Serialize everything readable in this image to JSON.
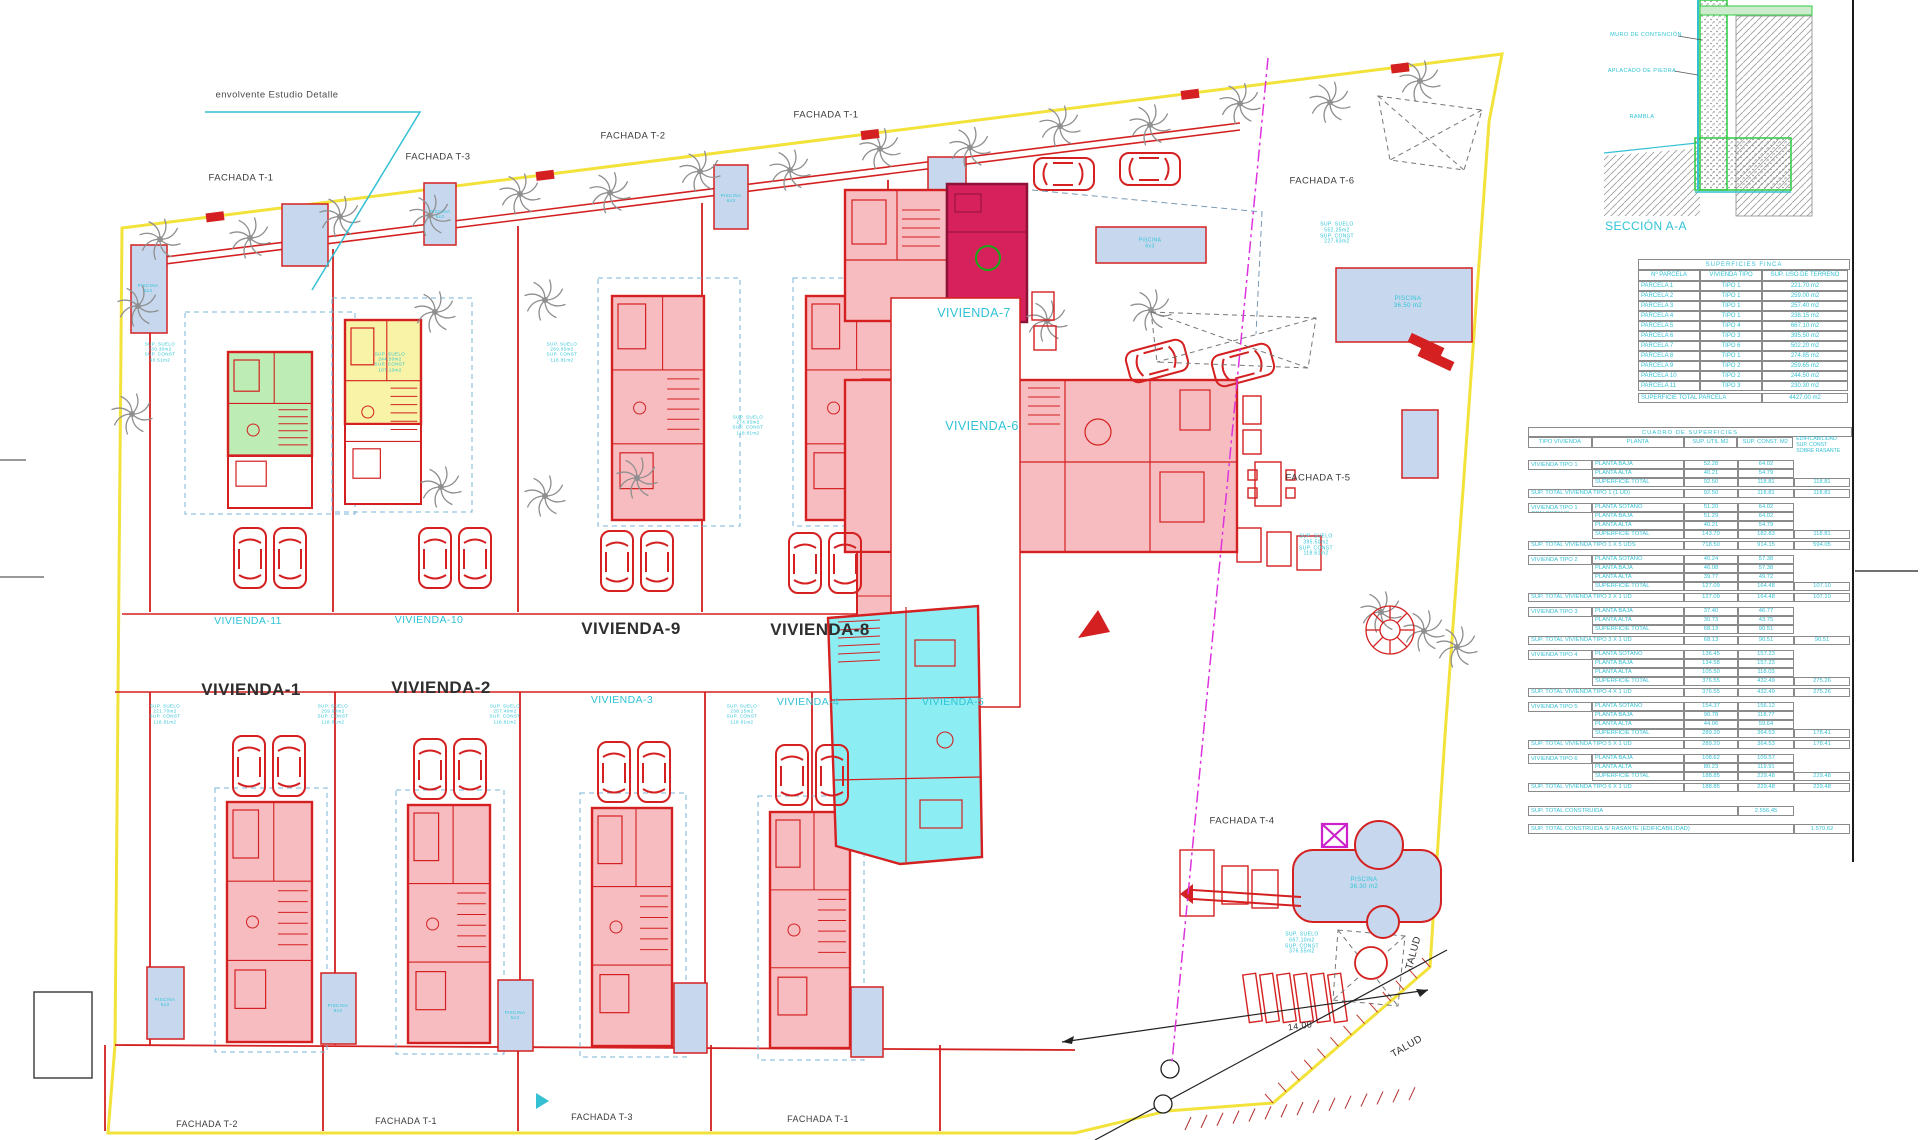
{
  "drawing_title": "Plano de emplazamiento viviendas",
  "colors": {
    "boundary_yellow": "#f2e23a",
    "wall_red": "#d42020",
    "plan_pink": "#f7bcc0",
    "plan_green": "#bdecb4",
    "plan_yellow": "#f8f3a6",
    "plan_crimson": "#d6215d",
    "plan_cyan": "#8ceef2",
    "pool_blue": "#c7d8ee",
    "annotation_cyan": "#2fc3d6",
    "magenta_line": "#dd33dd",
    "tree_gray": "#8f8f8f"
  },
  "plan_labels": [
    {
      "name": "label-envolvente-estudio-detalle",
      "text": "envolvente Estudio Detalle",
      "x": 277,
      "y": 96,
      "size": 9.5,
      "color": "#4a4a4a"
    },
    {
      "name": "label-fachada-t1-top-left",
      "text": "FACHADA T-1",
      "x": 241,
      "y": 179,
      "size": 9.5,
      "color": "#3c3c3c"
    },
    {
      "name": "label-fachada-t3-top",
      "text": "FACHADA T-3",
      "x": 438,
      "y": 158,
      "size": 9.5,
      "color": "#3c3c3c"
    },
    {
      "name": "label-fachada-t2-top",
      "text": "FACHADA T-2",
      "x": 633,
      "y": 137,
      "size": 9.5,
      "color": "#3c3c3c"
    },
    {
      "name": "label-fachada-t1-top",
      "text": "FACHADA T-1",
      "x": 826,
      "y": 116,
      "size": 9.5,
      "color": "#3c3c3c"
    },
    {
      "name": "label-fachada-t6",
      "text": "FACHADA T-6",
      "x": 1322,
      "y": 182,
      "size": 9.5,
      "color": "#3c3c3c"
    },
    {
      "name": "label-fachada-t5",
      "text": "FACHADA T-5",
      "x": 1318,
      "y": 479,
      "size": 9.5,
      "color": "#3c3c3c"
    },
    {
      "name": "label-fachada-t4",
      "text": "FACHADA T-4",
      "x": 1242,
      "y": 822,
      "size": 9.5,
      "color": "#3c3c3c"
    },
    {
      "name": "label-fachada-t2-bottom",
      "text": "FACHADA T-2",
      "x": 207,
      "y": 1124,
      "size": 9,
      "color": "#3c3c3c"
    },
    {
      "name": "label-fachada-t1-bottom-a",
      "text": "FACHADA T-1",
      "x": 406,
      "y": 1121,
      "size": 9,
      "color": "#3c3c3c"
    },
    {
      "name": "label-fachada-t3-bottom",
      "text": "FACHADA T-3",
      "x": 602,
      "y": 1117,
      "size": 9,
      "color": "#3c3c3c"
    },
    {
      "name": "label-fachada-t1-bottom-b",
      "text": "FACHADA T-1",
      "x": 818,
      "y": 1119,
      "size": 9,
      "color": "#3c3c3c"
    },
    {
      "name": "label-vivienda-11",
      "text": "VIVIENDA-11",
      "x": 248,
      "y": 621,
      "size": 10.5,
      "color": "#2fc3d6"
    },
    {
      "name": "label-vivienda-10",
      "text": "VIVIENDA-10",
      "x": 429,
      "y": 620,
      "size": 10.5,
      "color": "#2fc3d6"
    },
    {
      "name": "label-vivienda-9",
      "text": "VIVIENDA-9",
      "x": 631,
      "y": 629,
      "size": 17,
      "color": "#2e2e2e",
      "bold": true
    },
    {
      "name": "label-vivienda-8",
      "text": "VIVIENDA-8",
      "x": 820,
      "y": 630,
      "size": 17,
      "color": "#2e2e2e",
      "bold": true
    },
    {
      "name": "label-vivienda-1",
      "text": "VIVIENDA-1",
      "x": 251,
      "y": 690,
      "size": 17,
      "color": "#2e2e2e",
      "bold": true
    },
    {
      "name": "label-vivienda-2",
      "text": "VIVIENDA-2",
      "x": 441,
      "y": 688,
      "size": 17,
      "color": "#2e2e2e",
      "bold": true
    },
    {
      "name": "label-vivienda-3",
      "text": "VIVIENDA-3",
      "x": 622,
      "y": 700,
      "size": 10.5,
      "color": "#2fc3d6"
    },
    {
      "name": "label-vivienda-4",
      "text": "VIVIENDA-4",
      "x": 808,
      "y": 702,
      "size": 10.5,
      "color": "#2fc3d6"
    },
    {
      "name": "label-vivienda-5",
      "text": "VIVIENDA-5",
      "x": 953,
      "y": 702,
      "size": 10.5,
      "color": "#2fc3d6"
    },
    {
      "name": "label-vivienda-7",
      "text": "VIVIENDA-7",
      "x": 974,
      "y": 313,
      "size": 12.5,
      "color": "#2fc3d6"
    },
    {
      "name": "label-vivienda-6",
      "text": "VIVIENDA-6",
      "x": 982,
      "y": 426,
      "size": 12.5,
      "color": "#2fc3d6"
    },
    {
      "name": "label-talud-east",
      "text": "TALUD",
      "x": 1414,
      "y": 953,
      "size": 10,
      "color": "#2e2e2e",
      "rot": -75
    },
    {
      "name": "label-talud-south",
      "text": "TALUD",
      "x": 1407,
      "y": 1047,
      "size": 10,
      "color": "#2e2e2e",
      "rot": -30
    },
    {
      "name": "label-dimension-14",
      "text": "14.00",
      "x": 1300,
      "y": 1026,
      "size": 9,
      "color": "#2e2e2e",
      "rot": -8
    },
    {
      "name": "label-seccion-aa",
      "text": "SECCIÓN A-A",
      "x": 1646,
      "y": 227,
      "size": 12,
      "color": "#2fc3d6"
    },
    {
      "name": "label-muro-contencion",
      "text": "MURO DE CONTENCIÓN",
      "x": 1646,
      "y": 35,
      "size": 5.5,
      "color": "#2fc3d6"
    },
    {
      "name": "label-aplacado-piedra",
      "text": "APLACADO DE PIEDRA",
      "x": 1642,
      "y": 71,
      "size": 5.5,
      "color": "#2fc3d6"
    },
    {
      "name": "label-rambla",
      "text": "RAMBLA",
      "x": 1642,
      "y": 117,
      "size": 5.5,
      "color": "#2fc3d6"
    },
    {
      "name": "label-sup-parcela-7",
      "text": "SUP. SUELO\n552.25m2\nSUP. CONST\n227.63m2",
      "x": 1337,
      "y": 234,
      "size": 5,
      "color": "#2fc3d6"
    },
    {
      "name": "label-sup-parcela-6",
      "text": "SUP. SUELO\n395.50m2\nSUP. CONST\n118.61m2",
      "x": 1316,
      "y": 546,
      "size": 5,
      "color": "#2fc3d6"
    },
    {
      "name": "label-sup-parcela-5",
      "text": "SUP. SUELO\n667.10m2\nSUP. CONST\n376.55m2",
      "x": 1302,
      "y": 944,
      "size": 5,
      "color": "#2fc3d6"
    },
    {
      "name": "label-piscina-northeast",
      "text": "PISCINA\n36.50 m2",
      "x": 1408,
      "y": 303,
      "size": 6,
      "color": "#2fc3d6"
    },
    {
      "name": "label-piscina-southeast",
      "text": "PISCINA\n36.30 m2",
      "x": 1364,
      "y": 884,
      "size": 6,
      "color": "#2fc3d6"
    },
    {
      "name": "label-piscina-north",
      "text": "PISCINA\n6x3",
      "x": 1150,
      "y": 244,
      "size": 5,
      "color": "#2fc3d6"
    },
    {
      "name": "label-sup-vivienda-11",
      "text": "SUP. SUELO\n230.30m2\nSUP. CONST\n90.51m2",
      "x": 160,
      "y": 352,
      "size": 4.5,
      "color": "#2fc3d6"
    },
    {
      "name": "label-sup-vivienda-10",
      "text": "SUP. SUELO\n244.50m2\nSUP. CONST\n107.10m2",
      "x": 390,
      "y": 362,
      "size": 4.5,
      "color": "#2fc3d6"
    },
    {
      "name": "label-sup-vivienda-9",
      "text": "SUP. SUELO\n259.65m2\nSUP. CONST\n118.81m2",
      "x": 562,
      "y": 352,
      "size": 4.5,
      "color": "#2fc3d6"
    },
    {
      "name": "label-sup-vivienda-8",
      "text": "SUP. SUELO\n274.85m2\nSUP. CONST\n118.81m2",
      "x": 748,
      "y": 425,
      "size": 4.5,
      "color": "#2fc3d6"
    },
    {
      "name": "label-sup-vivienda-1",
      "text": "SUP. SUELO\n221.70m2\nSUP. CONST\n118.81m2",
      "x": 165,
      "y": 714,
      "size": 4.5,
      "color": "#2fc3d6"
    },
    {
      "name": "label-sup-vivienda-2",
      "text": "SUP. SUELO\n259.00m2\nSUP. CONST\n118.81m2",
      "x": 333,
      "y": 714,
      "size": 4.5,
      "color": "#2fc3d6"
    },
    {
      "name": "label-sup-vivienda-3",
      "text": "SUP. SUELO\n257.40m2\nSUP. CONST\n118.81m2",
      "x": 505,
      "y": 714,
      "size": 4.5,
      "color": "#2fc3d6"
    },
    {
      "name": "label-sup-vivienda-4",
      "text": "SUP. SUELO\n238.15m2\nSUP. CONST\n118.81m2",
      "x": 742,
      "y": 714,
      "size": 4.5,
      "color": "#2fc3d6"
    },
    {
      "name": "label-piscina-small-1",
      "text": "PISCINA\n6x3",
      "x": 148,
      "y": 288,
      "size": 4.5,
      "color": "#2fc3d6"
    },
    {
      "name": "label-piscina-small-2",
      "text": "PISCINA\n6x3",
      "x": 440,
      "y": 214,
      "size": 4.5,
      "color": "#2fc3d6"
    },
    {
      "name": "label-piscina-small-3",
      "text": "PISCINA\n6x3",
      "x": 731,
      "y": 198,
      "size": 4.5,
      "color": "#2fc3d6"
    },
    {
      "name": "label-piscina-small-4",
      "text": "PISCINA\n6x3",
      "x": 165,
      "y": 1002,
      "size": 4.5,
      "color": "#2fc3d6"
    },
    {
      "name": "label-piscina-small-5",
      "text": "PISCINA\n6x3",
      "x": 338,
      "y": 1008,
      "size": 4.5,
      "color": "#2fc3d6"
    },
    {
      "name": "label-piscina-small-6",
      "text": "PISCINA\n6x3",
      "x": 515,
      "y": 1015,
      "size": 4.5,
      "color": "#2fc3d6"
    }
  ],
  "finca_table": {
    "title": "SUPERFICIES FINCA",
    "headers": [
      "Nº PARCELA",
      "VIVIENDA TIPO",
      "SUP. USO DE TERRENO"
    ],
    "rows": [
      [
        "PARCELA 1",
        "TIPO 1",
        "221.70 m2"
      ],
      [
        "PARCELA 2",
        "TIPO 1",
        "259.00 m2"
      ],
      [
        "PARCELA 3",
        "TIPO 1",
        "257.40 m2"
      ],
      [
        "PARCELA 4",
        "TIPO 1",
        "238.15 m2"
      ],
      [
        "PARCELA 5",
        "TIPO 4",
        "667.10 m2"
      ],
      [
        "PARCELA 6",
        "TIPO 3",
        "395.50 m2"
      ],
      [
        "PARCELA 7",
        "TIPO 6",
        "502.20 m2"
      ],
      [
        "PARCELA 8",
        "TIPO 1",
        "274.85 m2"
      ],
      [
        "PARCELA 9",
        "TIPO 2",
        "259.65 m2"
      ],
      [
        "PARCELA 10",
        "TIPO 2",
        "244.50 m2"
      ],
      [
        "PARCELA 11",
        "TIPO 3",
        "230.30 m2"
      ]
    ],
    "total_label": "SUPERFICIE TOTAL PARCELA",
    "total_value": "4427.00 m2"
  },
  "areas_table": {
    "title": "CUADRO DE SUPERFICIES",
    "headers": [
      "TIPO VIVIENDA",
      "PLANTA",
      "SUP. UTIL M2",
      "SUP. CONST. M2"
    ],
    "note": "EDIFICABILIDAD\nSUP. CONST\nSOBRE RASANTE",
    "groups": [
      {
        "tipo": "VIVIENDA TIPO 1",
        "rows": [
          [
            "PLANTA BAJA",
            "52.28",
            "64.02",
            ""
          ],
          [
            "PLANTA ALTA",
            "40.21",
            "54.79",
            ""
          ],
          [
            "SUPERFICIE TOTAL",
            "92.50",
            "118.81",
            "118.81"
          ]
        ],
        "total": [
          "SUP. TOTAL VIVIENDA TIPO 1 (1 UD)",
          "92.50",
          "118.81",
          "118.81"
        ]
      },
      {
        "tipo": "VIVIENDA TIPO 1 CON SOTANO",
        "rows": [
          [
            "PLANTA SOTANO",
            "51.20",
            "64.02",
            ""
          ],
          [
            "PLANTA BAJA",
            "51.29",
            "64.02",
            ""
          ],
          [
            "PLANTA ALTA",
            "40.21",
            "54.79",
            ""
          ],
          [
            "SUPERFICIE TOTAL",
            "143.70",
            "182.83",
            "118.81"
          ]
        ],
        "total": [
          "SUP. TOTAL VIVIENDA TIPO 1 X 5 UDS",
          "718.50",
          "914.15",
          "594.05"
        ]
      },
      {
        "tipo": "VIVIENDA TIPO 2",
        "rows": [
          [
            "PLANTA SOTANO",
            "40.24",
            "57.38",
            ""
          ],
          [
            "PLANTA BAJA",
            "46.08",
            "57.38",
            ""
          ],
          [
            "PLANTA ALTA",
            "39.77",
            "49.72",
            ""
          ],
          [
            "SUPERFICIE TOTAL",
            "127.09",
            "164.48",
            "107.10"
          ]
        ],
        "total": [
          "SUP. TOTAL VIVIENDA TIPO 2 X 1 UD",
          "127.09",
          "164.48",
          "107.10"
        ]
      },
      {
        "tipo": "VIVIENDA TIPO 3",
        "rows": [
          [
            "PLANTA BAJA",
            "37.40",
            "46.77",
            ""
          ],
          [
            "PLANTA ALTA",
            "30.73",
            "43.75",
            ""
          ],
          [
            "SUPERFICIE TOTAL",
            "68.13",
            "90.51",
            ""
          ]
        ],
        "total": [
          "SUP. TOTAL VIVIENDA TIPO 3 X 1 UD",
          "68.13",
          "90.51",
          "90.51"
        ]
      },
      {
        "tipo": "VIVIENDA TIPO 4",
        "rows": [
          [
            "PLANTA SOTANO",
            "136.45",
            "157.23",
            ""
          ],
          [
            "PLANTA BAJA",
            "134.58",
            "157.23",
            ""
          ],
          [
            "PLANTA ALTA",
            "105.50",
            "118.03",
            ""
          ],
          [
            "SUPERFICIE TOTAL",
            "376.55",
            "432.49",
            "275.26"
          ]
        ],
        "total": [
          "SUP. TOTAL VIVIENDA TIPO 4 X 1 UD",
          "376.55",
          "432.49",
          "275.26"
        ]
      },
      {
        "tipo": "VIVIENDA TIPO 5",
        "rows": [
          [
            "PLANTA SOTANO",
            "154.37",
            "156.12",
            ""
          ],
          [
            "PLANTA BAJA",
            "90.78",
            "118.77",
            ""
          ],
          [
            "PLANTA ALTA",
            "44.06",
            "59.64",
            ""
          ],
          [
            "SUPERFICIE TOTAL",
            "289.20",
            "364.53",
            "178.41"
          ]
        ],
        "total": [
          "SUP. TOTAL VIVIENDA TIPO 5 X 1 UD",
          "289.20",
          "364.53",
          "178.41"
        ]
      },
      {
        "tipo": "VIVIENDA TIPO 6",
        "rows": [
          [
            "PLANTA BAJA",
            "108.62",
            "109.57",
            ""
          ],
          [
            "PLANTA ALTA",
            "80.23",
            "119.91",
            ""
          ],
          [
            "SUPERFICIE TOTAL",
            "188.85",
            "229.48",
            "229.48"
          ]
        ],
        "total": [
          "SUP. TOTAL VIVIENDA TIPO 6 X 1 UD",
          "188.85",
          "229.48",
          "229.48"
        ]
      }
    ],
    "grand_totals": [
      {
        "label": "SUP. TOTAL CONSTRUIDA",
        "value": "2.556,45"
      },
      {
        "label": "SUP. TOTAL CONSTRUIDA S/ RASANTE (EDIFICABILIDAD)",
        "value": "1.570,62"
      }
    ]
  }
}
